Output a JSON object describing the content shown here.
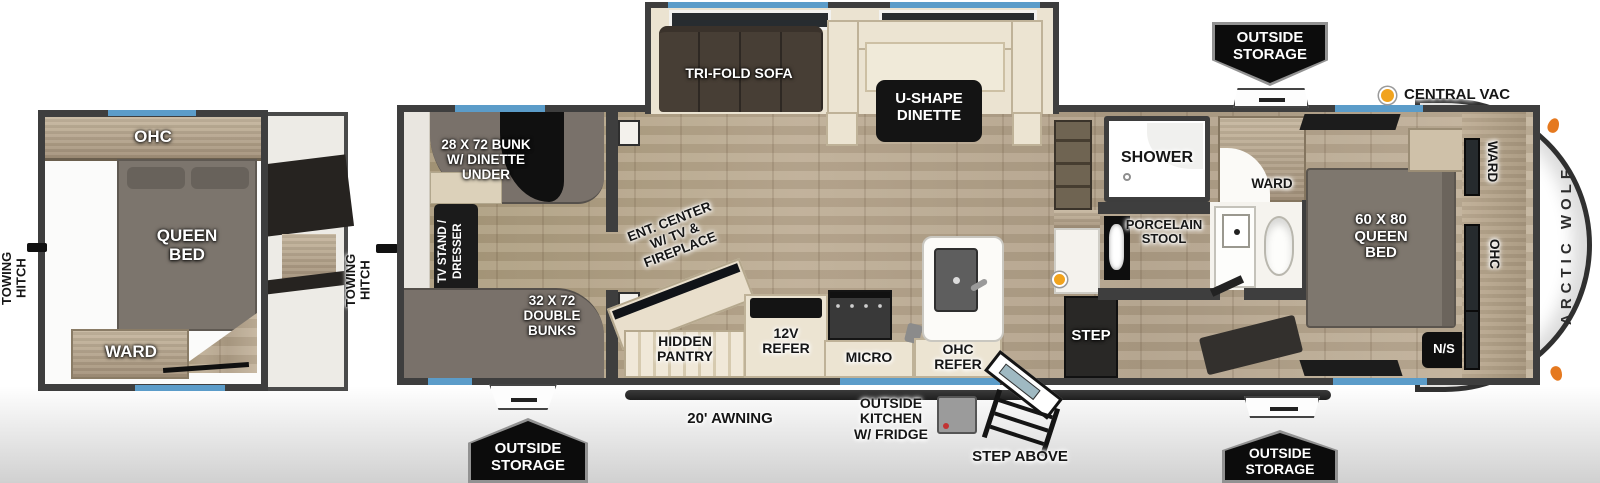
{
  "colors": {
    "accent_blue": "#5b9cc9",
    "wall_gray": "#3e3e3e",
    "central_vac_orange": "#f1a31d"
  },
  "left_plan": {
    "towing_hitch": "TOWING\nHITCH",
    "ohc": "OHC",
    "queen_bed": "QUEEN\nBED",
    "ward": "WARD"
  },
  "main_plan": {
    "towing_hitch": "TOWING\nHITCH",
    "brand": "ARCTIC WOLF",
    "bunk_room": {
      "bunk": "28 X 72 BUNK\nW/ DINETTE\nUNDER",
      "tv_stand": "TV STAND /\nDRESSER",
      "double_bunks": "32 X 72\nDOUBLE\nBUNKS"
    },
    "slide_out": {
      "sofa": "TRI-FOLD SOFA",
      "dinette": "U-SHAPE\nDINETTE"
    },
    "living": {
      "ent_center": "ENT. CENTER\nW/ TV &\nFIREPLACE",
      "hidden_pantry": "HIDDEN\nPANTRY",
      "refer_12v": "12V\nREFER",
      "micro": "MICRO",
      "ohc_refer": "OHC\nREFER",
      "step": "STEP"
    },
    "bath": {
      "shower": "SHOWER",
      "porcelain_stool": "PORCELAIN\nSTOOL",
      "ward": "WARD"
    },
    "bedroom": {
      "queen_bed": "60 X 80\nQUEEN\nBED",
      "night_stand": "N/S",
      "ward": "WARD",
      "ohc": "OHC"
    }
  },
  "exterior": {
    "outside_storage_top": "OUTSIDE\nSTORAGE",
    "outside_storage_bottom_left": "OUTSIDE\nSTORAGE",
    "outside_storage_bottom_right": "OUTSIDE\nSTORAGE",
    "central_vac": "CENTRAL VAC",
    "awning": "20' AWNING",
    "outside_kitchen": "OUTSIDE\nKITCHEN\nW/ FRIDGE",
    "step_above": "STEP ABOVE"
  }
}
